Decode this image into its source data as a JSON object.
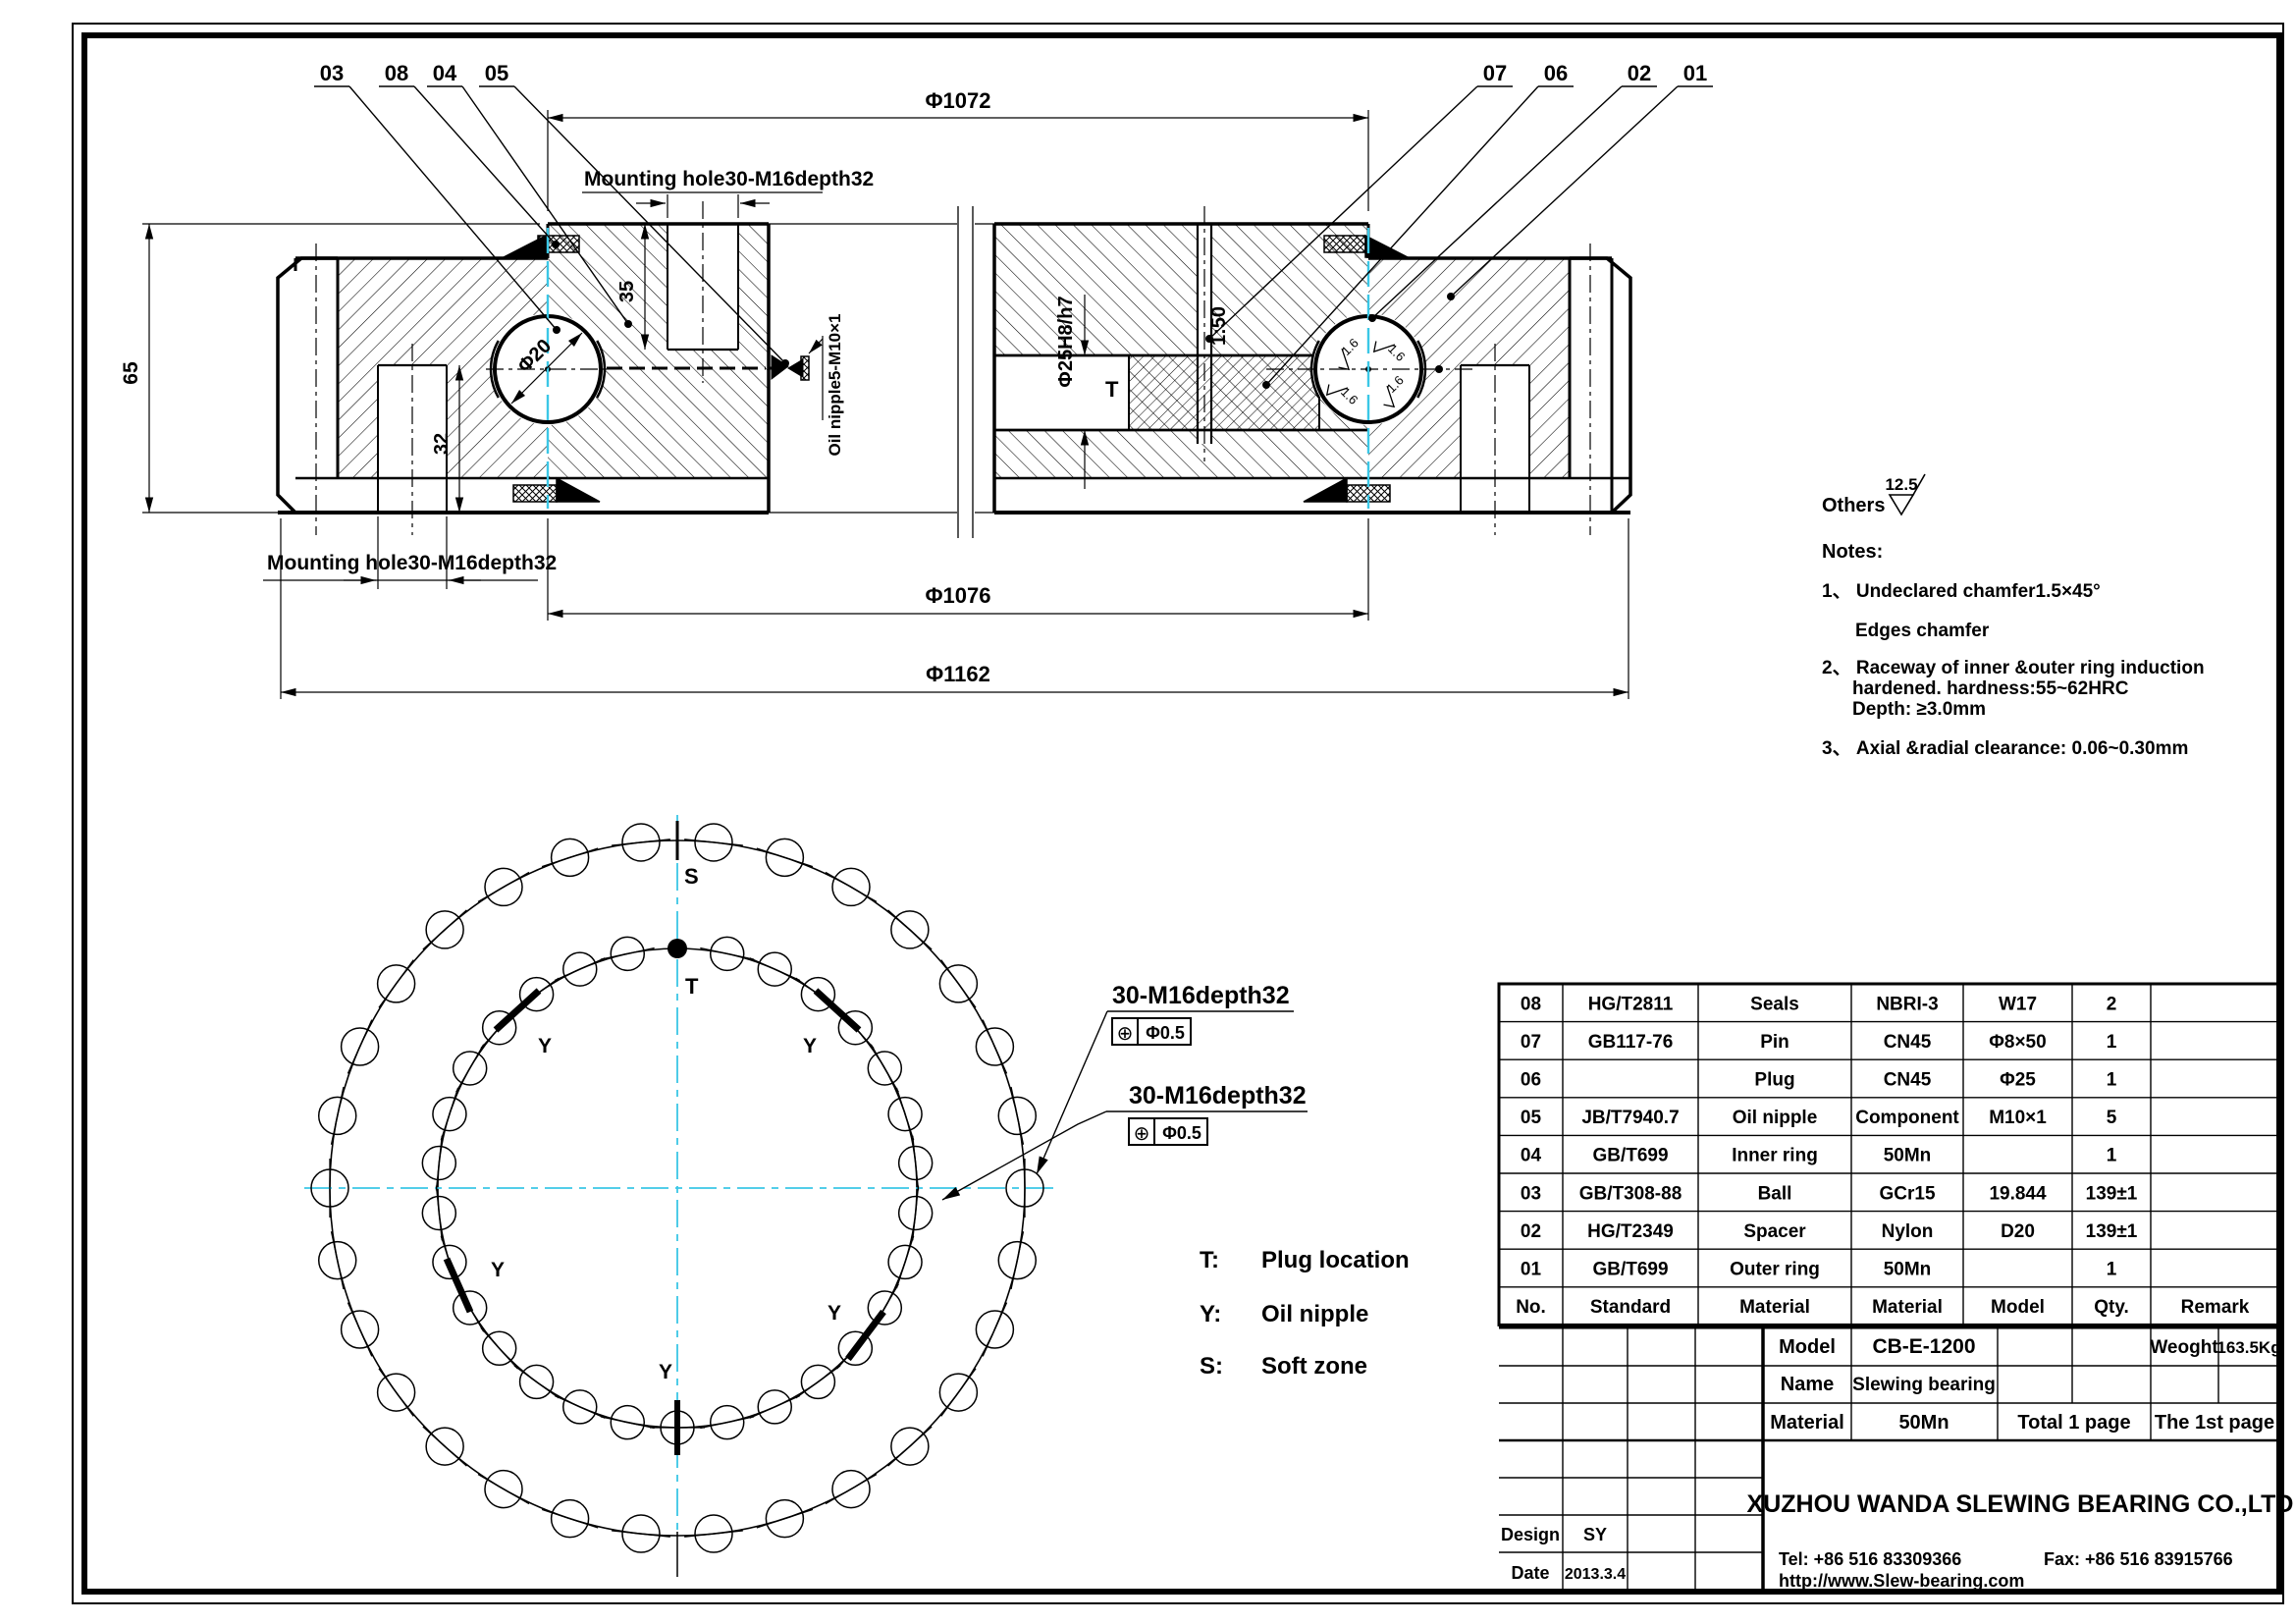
{
  "colors": {
    "line": "#000000",
    "centerline": "#3bc7e6",
    "paper": "#ffffff"
  },
  "balloons": {
    "left": [
      "03",
      "08",
      "04",
      "05"
    ],
    "right": [
      "07",
      "06",
      "02",
      "01"
    ]
  },
  "drawing": {
    "dims": {
      "phi1072": "Φ1072",
      "phi1076": "Φ1076",
      "phi1162": "Φ1162",
      "h65": "65",
      "d32": "32",
      "d35": "35",
      "ball": "Φ20",
      "plug_hole": "Φ25H8/h7",
      "taper": "1:50",
      "t_mark": "T",
      "finish": "1.6",
      "mount_top": "Mounting hole30-M16depth32",
      "mount_bottom": "Mounting hole30-M16depth32",
      "oil_nipple": "Oil nipple5-M10×1"
    },
    "callouts": {
      "upper": {
        "label": "30-M16depth32",
        "sym": "⊕",
        "tol": "Φ0.5"
      },
      "lower": {
        "label": "30-M16depth32",
        "sym": "⊕",
        "tol": "Φ0.5"
      }
    },
    "plan": {
      "s": "S",
      "t": "T",
      "y": "Y",
      "holes_outer": 30,
      "holes_inner": 30
    }
  },
  "surface": {
    "label": "Others",
    "value": "12.5"
  },
  "notes": {
    "title": "Notes:",
    "n1a": "1、 Undeclared  chamfer1.5×45°",
    "n1b": "Edges  chamfer",
    "n2a": "2、 Raceway  of  inner  &outer  ring  induction",
    "n2b": "hardened.  hardness:55~62HRC",
    "n2c": "Depth:  ≥3.0mm",
    "n3": "3、 Axial  &radial  clearance:  0.06~0.30mm"
  },
  "legend": {
    "items": [
      {
        "key": "T:",
        "value": "Plug  location"
      },
      {
        "key": "Y:",
        "value": "Oil  nipple"
      },
      {
        "key": "S:",
        "value": "Soft  zone"
      }
    ]
  },
  "bom": {
    "header": [
      "No.",
      "Standard",
      "Material",
      "Material",
      "Model",
      "Qty.",
      "Remark"
    ],
    "rows": [
      [
        "08",
        "HG/T2811",
        "Seals",
        "NBRI-3",
        "W17",
        "2",
        ""
      ],
      [
        "07",
        "GB117-76",
        "Pin",
        "CN45",
        "Φ8×50",
        "1",
        ""
      ],
      [
        "06",
        "",
        "Plug",
        "CN45",
        "Φ25",
        "1",
        ""
      ],
      [
        "05",
        "JB/T7940.7",
        "Oil nipple",
        "Component",
        "M10×1",
        "5",
        ""
      ],
      [
        "04",
        "GB/T699",
        "Inner ring",
        "50Mn",
        "",
        "1",
        ""
      ],
      [
        "03",
        "GB/T308-88",
        "Ball",
        "GCr15",
        "19.844",
        "139±1",
        ""
      ],
      [
        "02",
        "HG/T2349",
        "Spacer",
        "Nylon",
        "D20",
        "139±1",
        ""
      ],
      [
        "01",
        "GB/T699",
        "Outer ring",
        "50Mn",
        "",
        "1",
        ""
      ]
    ]
  },
  "title_block": {
    "model_label": "Model",
    "model": "CB-E-1200",
    "weight_label": "Weoght",
    "weight": "163.5Kg",
    "name_label": "Name",
    "name": "Slewing  bearing",
    "material_label": "Material",
    "material": "50Mn",
    "total": "Total  1  page",
    "page": "The  1st  page",
    "design_label": "Design",
    "design": "SY",
    "date_label": "Date",
    "date": "2013.3.4",
    "company": "XUZHOU  WANDA  SLEWING  BEARING  CO.,LTD",
    "tel": "Tel:  +86  516  83309366",
    "fax": "Fax:  +86  516  83915766",
    "url": "http://www.Slew-bearing.com"
  }
}
